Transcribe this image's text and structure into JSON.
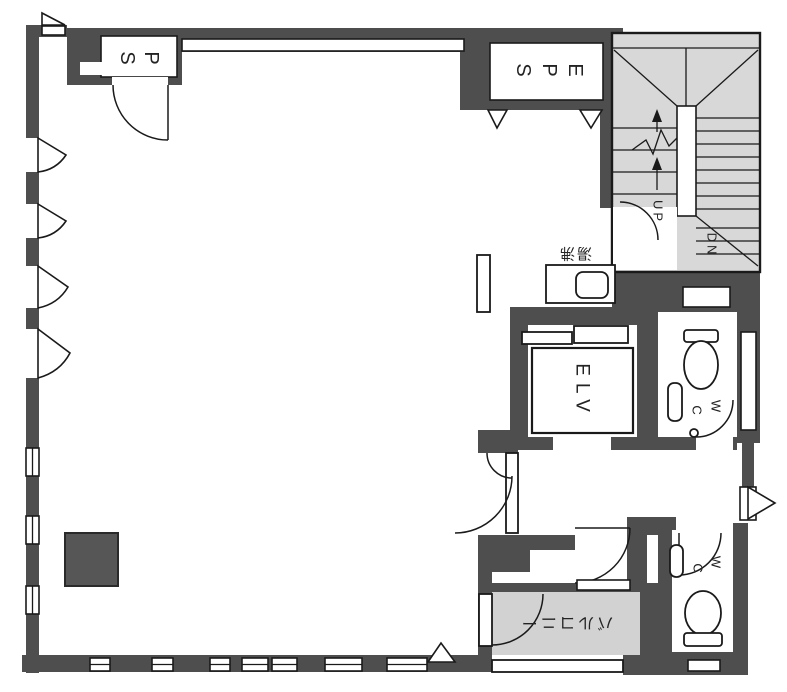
{
  "colors": {
    "wall": "#4e4e4e",
    "stair_fill": "#d8d8d8",
    "balcony_fill": "#d2d2d2",
    "column_fill": "#565656",
    "line": "#1a1a1a",
    "floor": "#ffffff"
  },
  "labels": {
    "ps": {
      "text": "PS",
      "screen_letters": [
        "S",
        "P"
      ]
    },
    "eps": {
      "text": "EPS",
      "screen_letters": [
        "S",
        "P",
        "E"
      ]
    },
    "elevator": {
      "text": "ELV"
    },
    "stairs": {
      "up": "UP",
      "down": "DN"
    },
    "kitchenette": {
      "text": "湯沸"
    },
    "wc_upper": {
      "text": "WC",
      "screen_letters": [
        "C",
        "W"
      ]
    },
    "wc_lower": {
      "text": "WC",
      "screen_letters": [
        "C",
        "W"
      ]
    },
    "balcony": {
      "text": "バルコニー"
    }
  }
}
